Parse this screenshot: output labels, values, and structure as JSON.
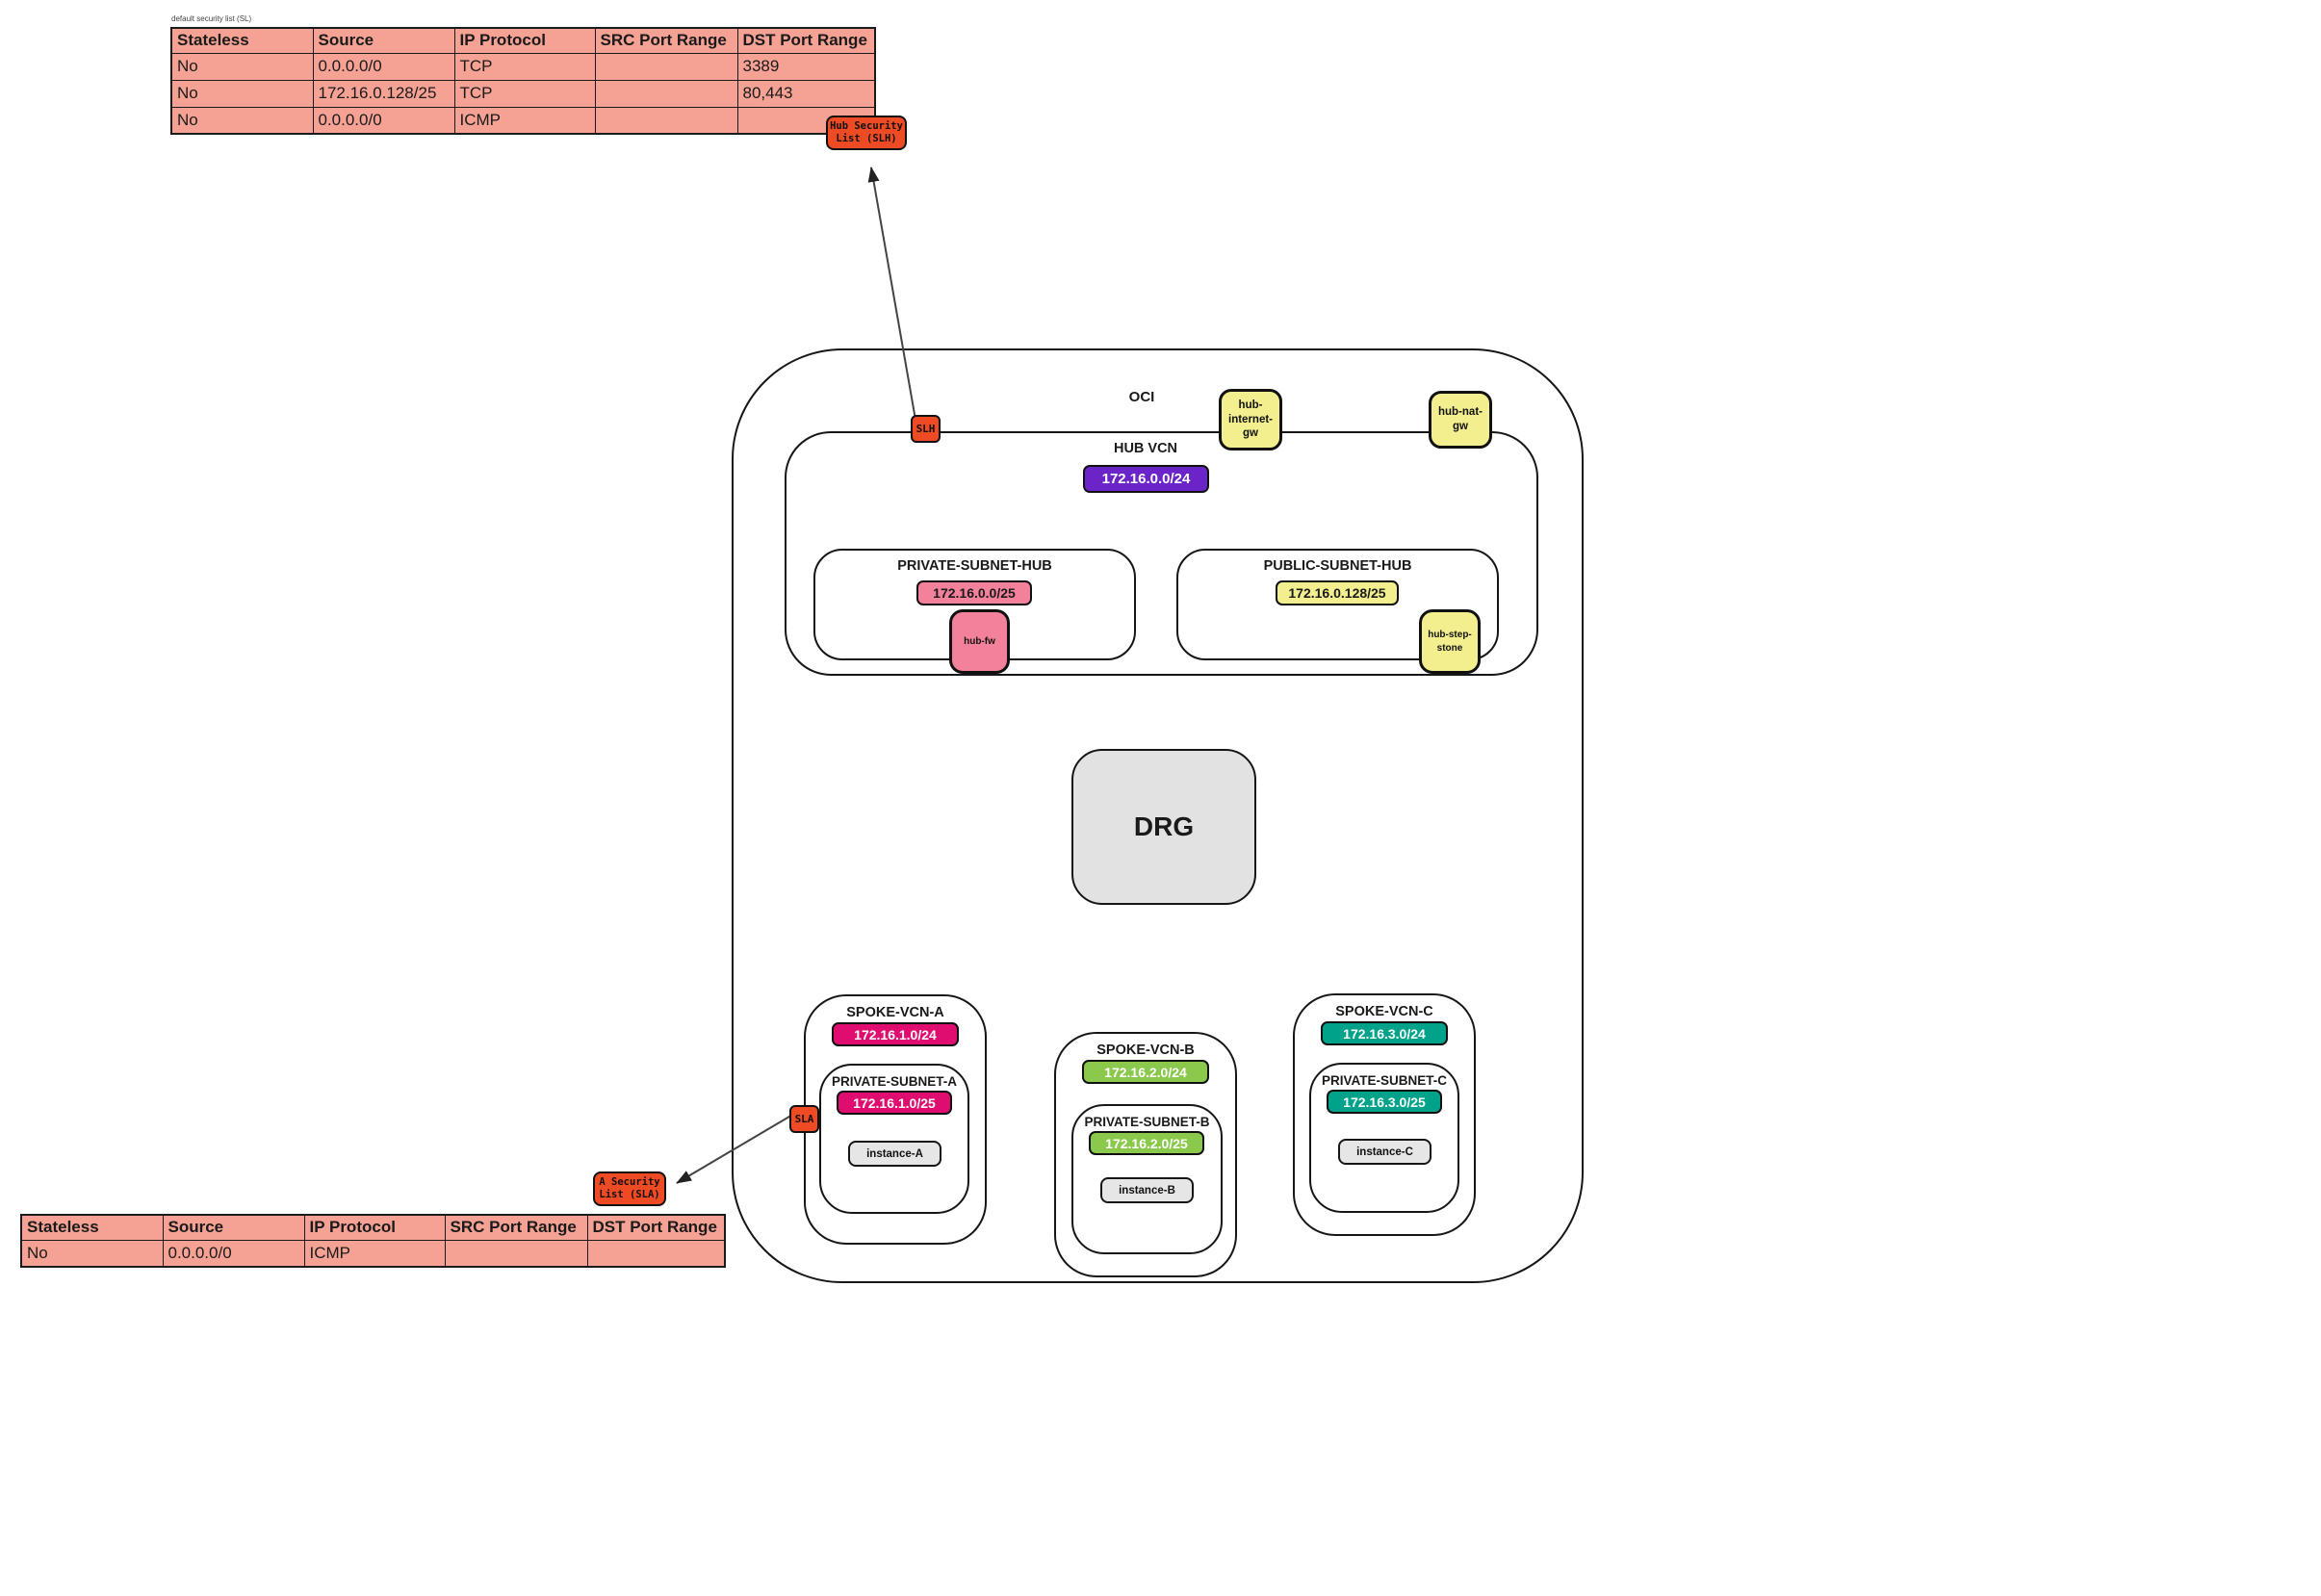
{
  "colors": {
    "table_fill": "#F5A294",
    "security_red": "#EE4A23",
    "gateway_yellow": "#F3EF8E",
    "hub_vcn_purple": "#6B24C8",
    "hub_subnet_pink": "#F4819B",
    "spoke_a_magenta": "#E00D70",
    "spoke_b_green": "#8BC94C",
    "spoke_c_teal": "#00A38A",
    "instance_gray": "#E6E6E6",
    "drg_gray": "#E2E2E2"
  },
  "hub_security_table": {
    "caption": "default security list (SL)",
    "headers": [
      "Stateless",
      "Source",
      "IP Protocol",
      "SRC Port Range",
      "DST Port Range"
    ],
    "rows": [
      [
        "No",
        "0.0.0.0/0",
        "TCP",
        "",
        "3389"
      ],
      [
        "No",
        "172.16.0.128/25",
        "TCP",
        "",
        "80,443"
      ],
      [
        "No",
        "0.0.0.0/0",
        "ICMP",
        "",
        ""
      ]
    ]
  },
  "spoke_security_table": {
    "headers": [
      "Stateless",
      "Source",
      "IP Protocol",
      "SRC Port Range",
      "DST Port Range"
    ],
    "rows": [
      [
        "No",
        "0.0.0.0/0",
        "ICMP",
        "",
        ""
      ]
    ]
  },
  "callouts": {
    "hub_security_list": [
      "Hub Security",
      "List (SLH)"
    ],
    "a_security_list": [
      "A Security",
      "List (SLA)"
    ],
    "slh_marker": "SLH",
    "sla_marker": "SLA"
  },
  "oci": {
    "label": "OCI",
    "drg_label": "DRG",
    "hub_vcn": {
      "label": "HUB VCN",
      "cidr": "172.16.0.0/24",
      "internet_gw_lines": [
        "hub-",
        "internet-",
        "gw"
      ],
      "nat_gw_lines": [
        "hub-nat-",
        "gw"
      ],
      "private_subnet": {
        "label": "PRIVATE-SUBNET-HUB",
        "cidr": "172.16.0.0/25",
        "firewall": "hub-fw"
      },
      "public_subnet": {
        "label": "PUBLIC-SUBNET-HUB",
        "cidr": "172.16.0.128/25",
        "stepstone_lines": [
          "hub-step-",
          "stone"
        ]
      }
    },
    "spokes": [
      {
        "label": "SPOKE-VCN-A",
        "cidr": "172.16.1.0/24",
        "subnet_label": "PRIVATE-SUBNET-A",
        "subnet_cidr": "172.16.1.0/25",
        "instance": "instance-A"
      },
      {
        "label": "SPOKE-VCN-B",
        "cidr": "172.16.2.0/24",
        "subnet_label": "PRIVATE-SUBNET-B",
        "subnet_cidr": "172.16.2.0/25",
        "instance": "instance-B"
      },
      {
        "label": "SPOKE-VCN-C",
        "cidr": "172.16.3.0/24",
        "subnet_label": "PRIVATE-SUBNET-C",
        "subnet_cidr": "172.16.3.0/25",
        "instance": "instance-C"
      }
    ]
  }
}
